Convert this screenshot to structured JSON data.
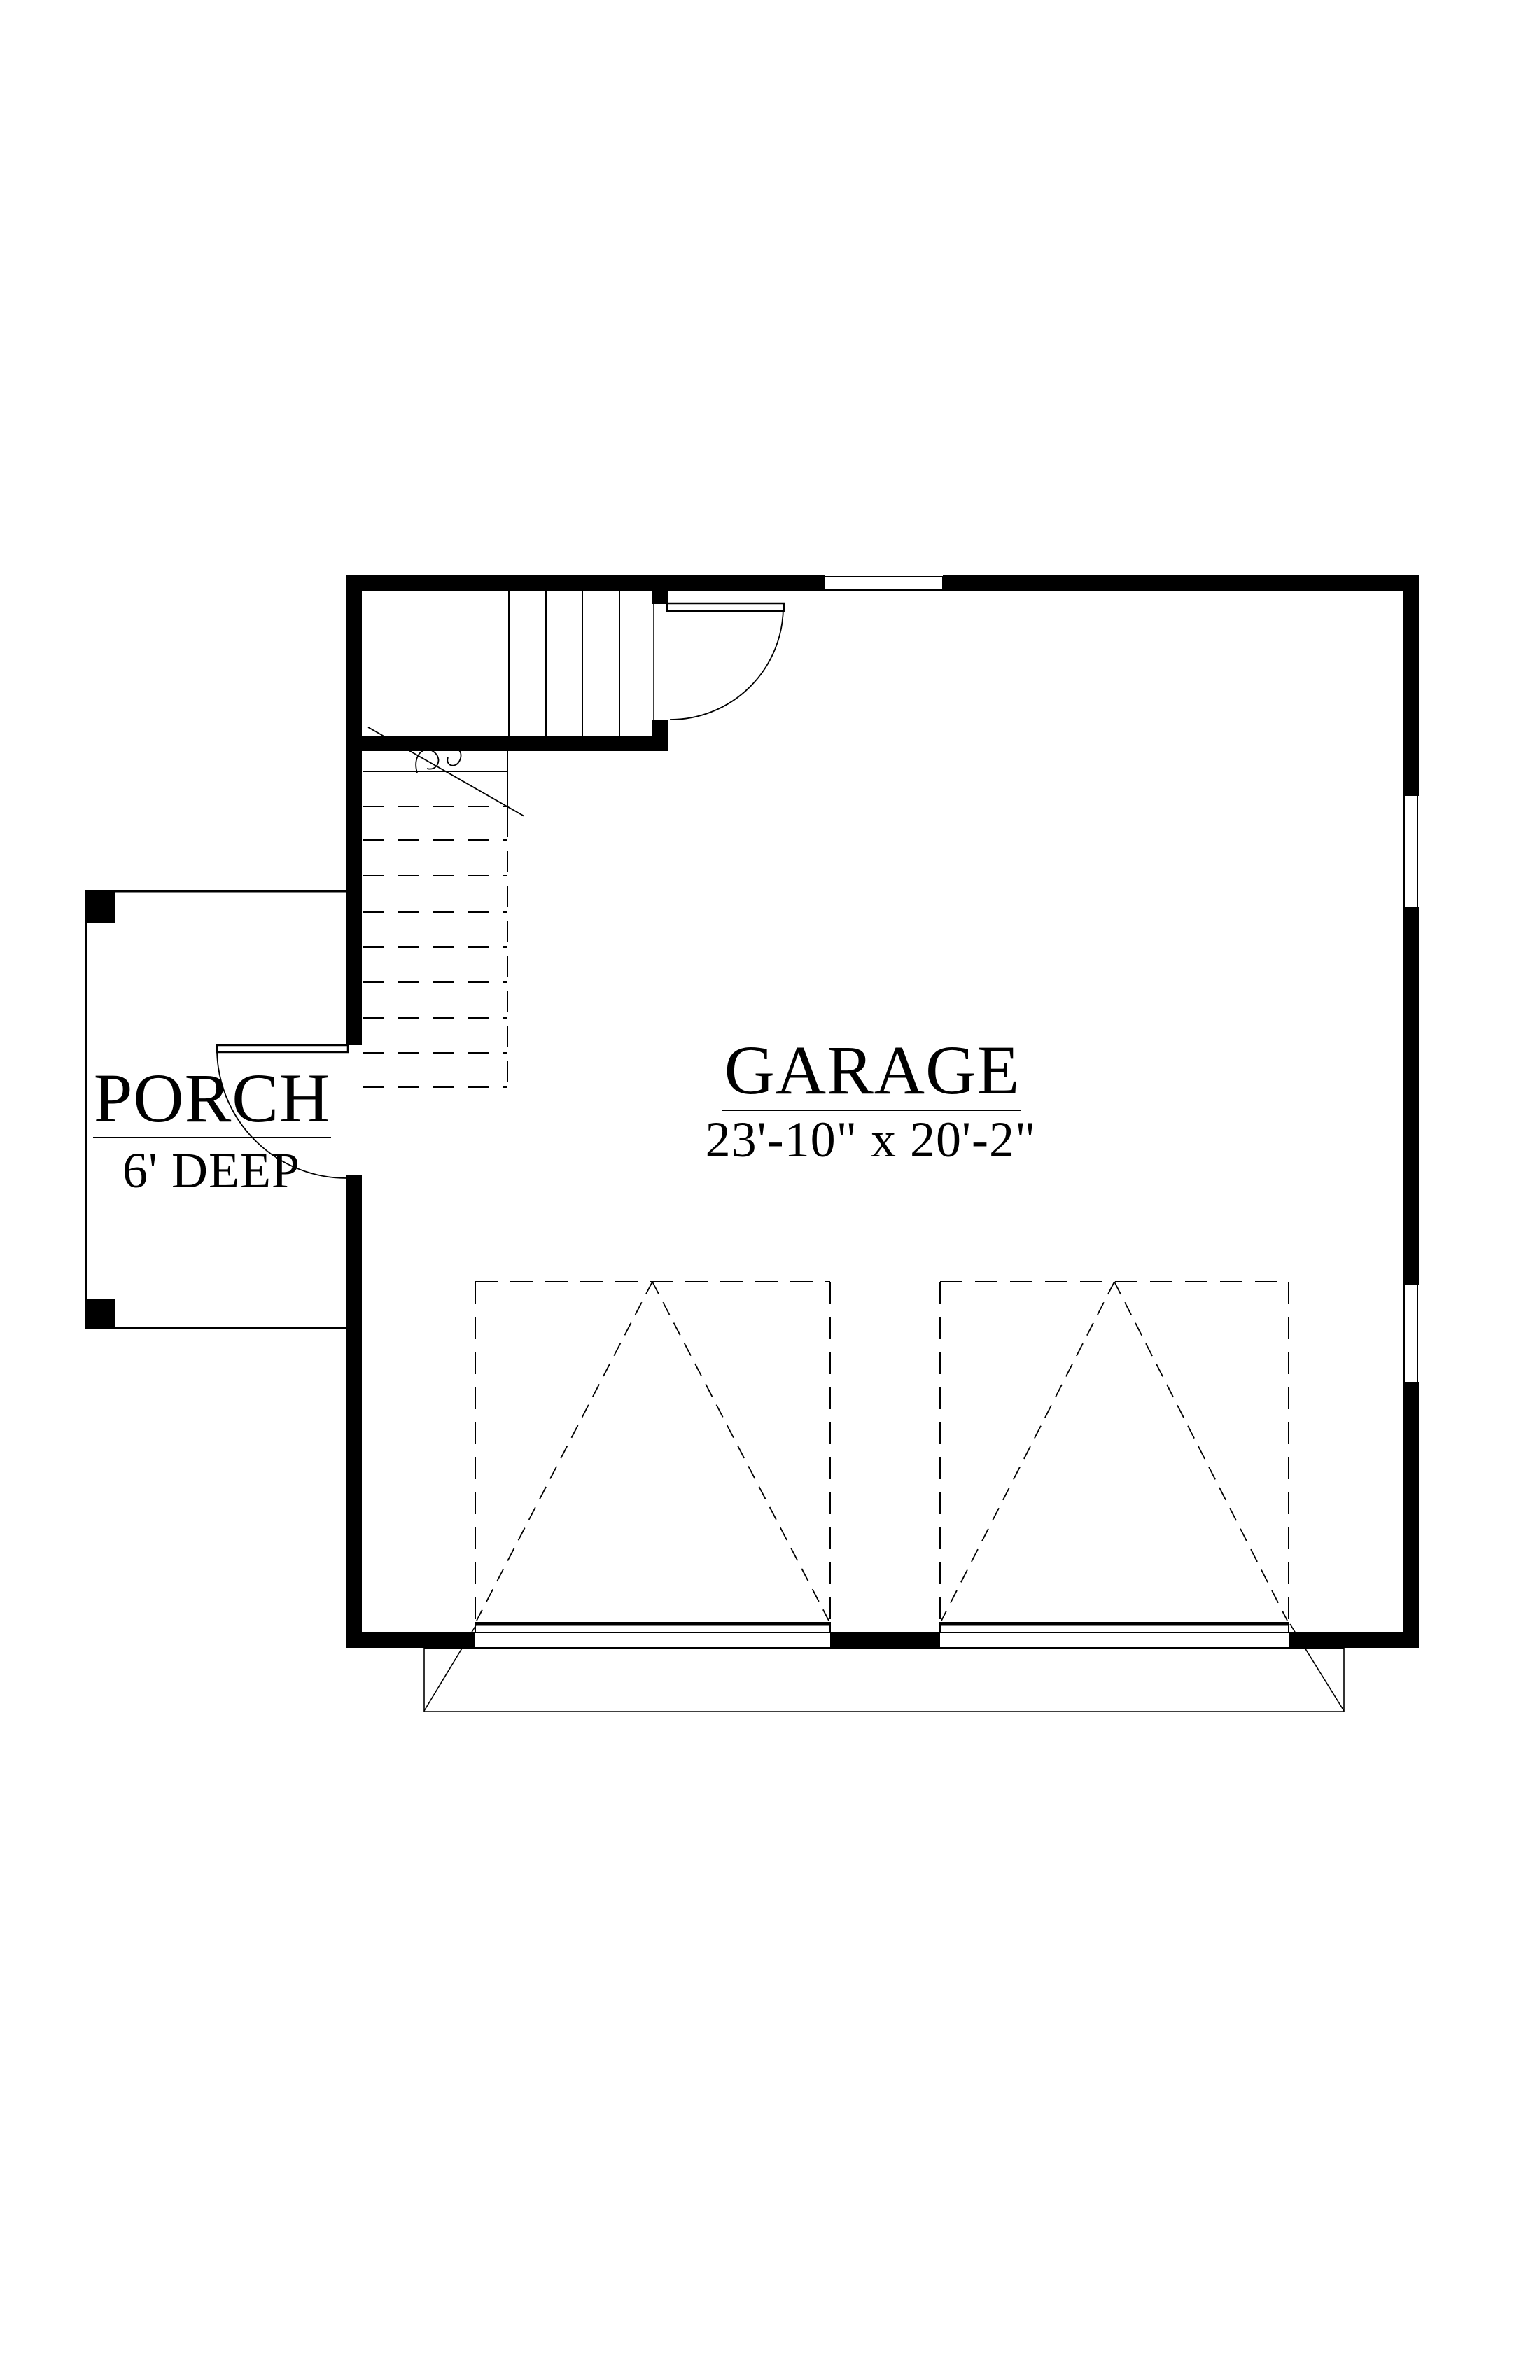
{
  "document": {
    "type": "architectural floor plan",
    "sheet_background": "#ffffff",
    "line_color": "#000000"
  },
  "rooms": {
    "garage": {
      "name": "GARAGE",
      "dimensions": "23'-10\" x 20'-2\""
    },
    "porch": {
      "name": "PORCH",
      "depth": "6' DEEP"
    }
  },
  "features": [
    "staircase with break line and dashed lower run",
    "stair door swinging into garage",
    "porch entry door swinging onto porch",
    "two overhead garage doors shown dashed",
    "window in top wall",
    "two windows in right wall",
    "driveway apron below garage doors",
    "two porch posts"
  ]
}
